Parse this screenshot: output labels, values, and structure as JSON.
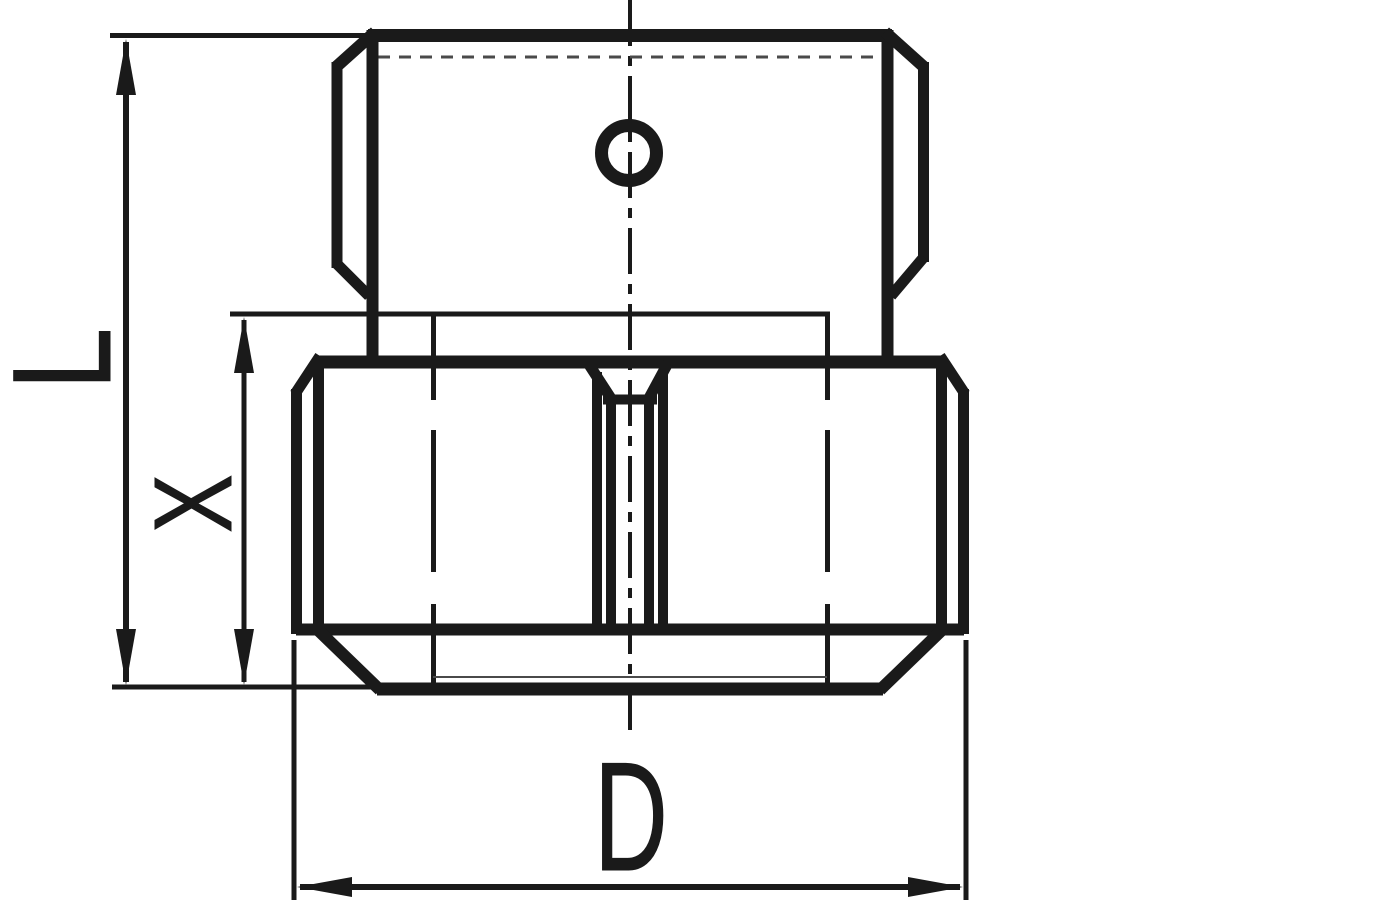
{
  "page": {
    "background_color": "#ffffff",
    "ink_color": "#1a1a1a"
  },
  "drawing": {
    "kind": "technical-line-drawing",
    "view": "front elevation of a two-part hexagonal screw fitting (small hex head on large hex body)",
    "labels": {
      "L": "L",
      "X": "X",
      "D": "D"
    },
    "dimensions": [
      {
        "id": "L",
        "label": "L",
        "orientation": "vertical",
        "spans": "full height of part"
      },
      {
        "id": "X",
        "label": "X",
        "orientation": "vertical",
        "spans": "height of lower hex section"
      },
      {
        "id": "D",
        "label": "D",
        "orientation": "horizontal",
        "spans": "across-flats width of lower hex"
      }
    ],
    "features": [
      "upper-hex-head with chamfered corners",
      "cross-hole circle on upper head",
      "fine thread line under upper head top edge",
      "lower-hex-body with chamfered top and bottom corners",
      "central tapered slot with parallel walls",
      "vertical dash-dot center line"
    ]
  }
}
